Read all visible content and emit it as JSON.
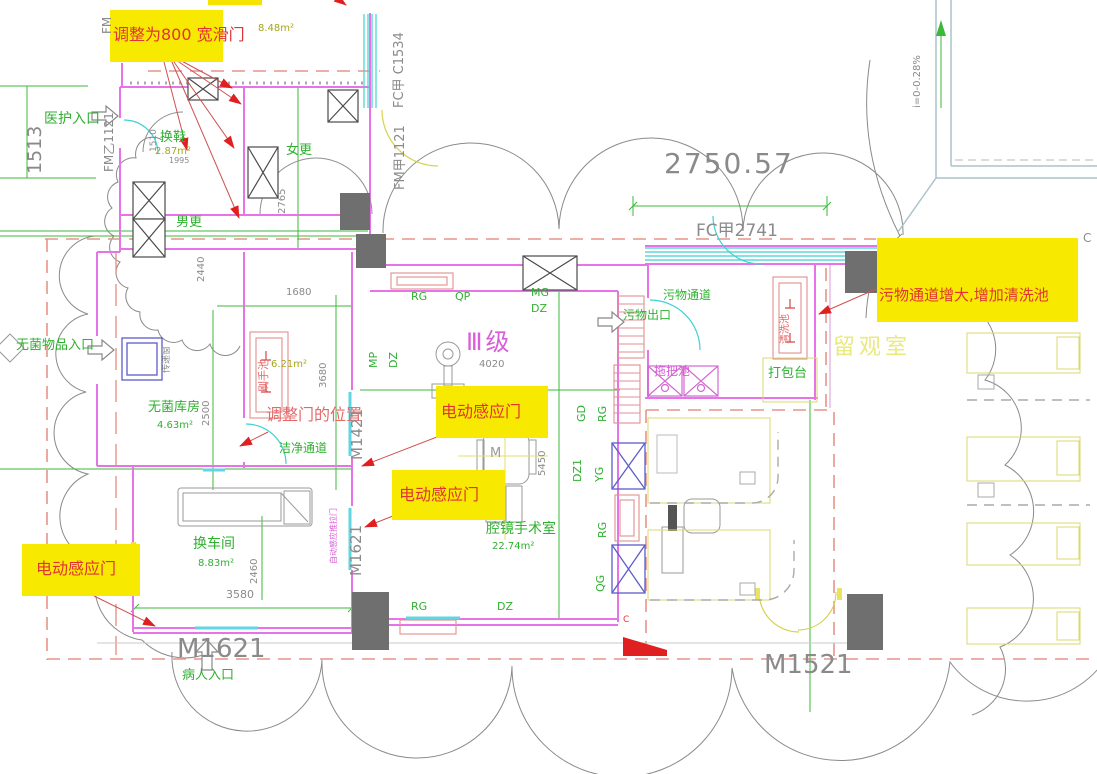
{
  "highlights": {
    "slide_door": "调整为800 宽滑门",
    "sensor_door": "电动感应门",
    "waste_note": "污物通道增大,增加清洗池"
  },
  "notes": {
    "door_position": "调整门的位置",
    "side_door_label": "自动感应推拉门"
  },
  "rooms": {
    "staff_entry": "医护入口",
    "shoe_change": "换鞋",
    "women_change": "女更",
    "men_change": "男更",
    "sterile_store": "无菌库房",
    "pass_window": "传递窗",
    "scrub_sink": "刷手池",
    "clean_corridor": "洁净通道",
    "cart_change": "换车间",
    "endo_or": "腔镜手术室",
    "or_class": "Ⅲ级",
    "waste_corridor": "污物通道",
    "waste_exit": "污物出口",
    "wash_sink": "清洗池",
    "mop_sink": "拖把池",
    "pack_table": "打包台",
    "observation": "留观室",
    "patient_entry": "病人入口",
    "sterile_goods_entry": "无菌物品入口"
  },
  "areas": {
    "upper": "8.48m²",
    "shoe_change": "2.87m²",
    "scrub": "6.21m²",
    "sterile_store": "4.63m²",
    "cart_change": "8.83m²",
    "endo_or": "22.74m²"
  },
  "doors": {
    "fm": "FM",
    "fm_b1121": "FM乙1121",
    "fm_a1121": "FM甲1121",
    "fc_c1534": "FC甲 C1534",
    "fc2741": "FC甲2741",
    "m1421": "M1421",
    "m1621": "M1621",
    "m1521": "M1521"
  },
  "dims": {
    "d1513": "1513",
    "d1510": "1510",
    "d1995": "1995",
    "d2440": "2440",
    "d2765": "2765",
    "d1680": "1680",
    "d2500": "2500",
    "d3680": "3680",
    "d4020": "4020",
    "d5450": "5450",
    "d2460": "2460",
    "d3580": "3580",
    "d2750": "2750.57",
    "slope": "i=0-0.28%"
  },
  "tags": {
    "rg": "RG",
    "qp": "QP",
    "mg": "MG",
    "dz": "DZ",
    "mp": "MP",
    "gd": "GD",
    "dz1": "DZ1",
    "yg": "YG",
    "qg": "QG",
    "m": "M",
    "c": "C"
  },
  "colors": {
    "highlight": "#f7ea00",
    "annotation_red": "#e03434",
    "room_green": "#2fb030",
    "wall_magenta": "#e873e8",
    "dim_gray": "#8a8a8a",
    "window_cyan": "#3fd1d1",
    "class_magenta": "#d85fd8",
    "observe_yellow": "#e9e97e"
  }
}
